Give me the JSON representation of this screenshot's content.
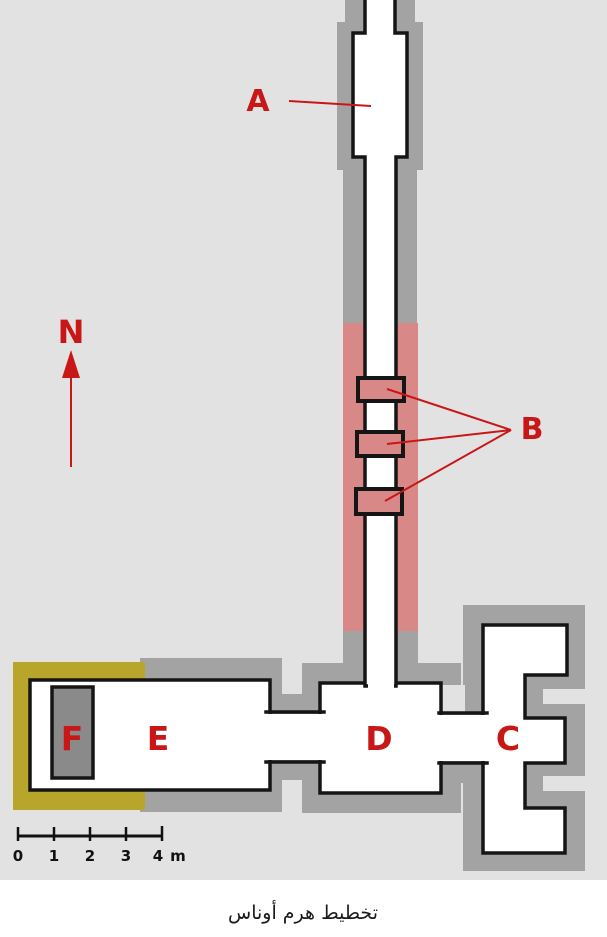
{
  "caption": "تخطيط هرم أوناس",
  "compass": {
    "north": "N"
  },
  "plan_labels": {
    "A": "A",
    "B": "B",
    "C": "C",
    "D": "D",
    "E": "E",
    "F": "F"
  },
  "scale_bar": {
    "ticks": [
      "0",
      "1",
      "2",
      "3",
      "4"
    ],
    "unit": "m"
  },
  "colors": {
    "background": "#e2e2e2",
    "masonry_gray": "#a3a3a3",
    "portcullis_pink": "#d98888",
    "restored_yellow": "#b7a52c",
    "sarcophagus_gray": "#8a8a8a",
    "wall_black": "#151515",
    "annotation_red": "#c81717"
  }
}
